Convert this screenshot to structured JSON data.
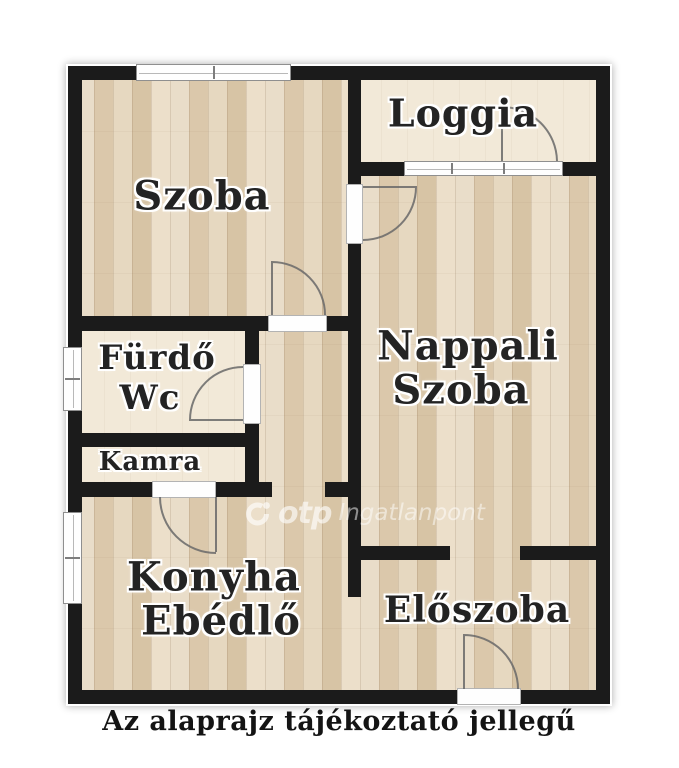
{
  "rooms": {
    "szoba": {
      "line1": "Szoba"
    },
    "loggia": {
      "line1": "Loggia"
    },
    "furdo": {
      "line1": "Fürdő",
      "line2": "Wc"
    },
    "kamra": {
      "line1": "Kamra"
    },
    "nappali": {
      "line1": "Nappali",
      "line2": "Szoba"
    },
    "konyha": {
      "line1": "Konyha",
      "line2": "Ebédlő"
    },
    "eloszoba": {
      "line1": "Előszoba"
    }
  },
  "watermark": {
    "brand": "otp",
    "name": "Ingatlanpont"
  },
  "footer": {
    "caption": "Az alaprajz tájékoztató jellegű"
  },
  "colors": {
    "wall": "#1b1b1b",
    "wood_floor": "#e2d3bb",
    "cream_floor": "#f2e9d8",
    "label_text": "#232323",
    "watermark_white": "rgba(255,255,255,0.6)"
  }
}
